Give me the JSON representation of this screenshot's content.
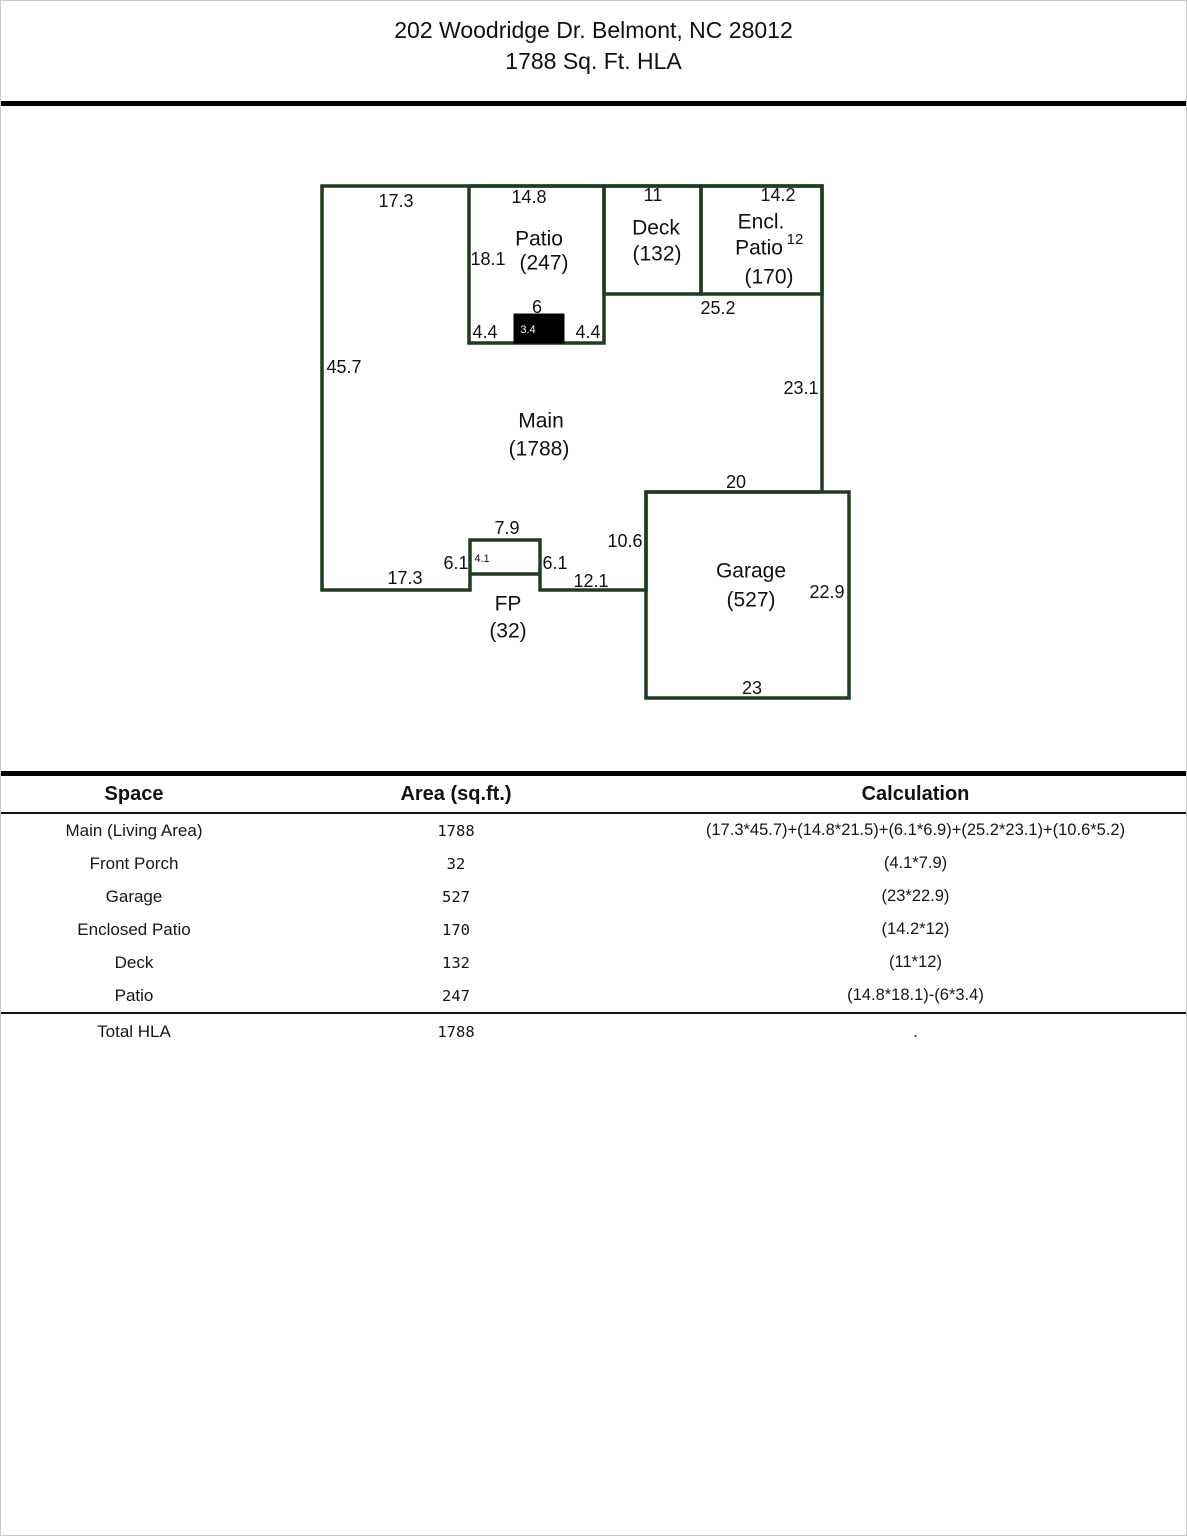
{
  "header": {
    "line1": "202 Woodridge Dr. Belmont, NC 28012",
    "line2": "1788 Sq. Ft. HLA"
  },
  "colors": {
    "plan_line": "#1e3c20",
    "divider": "#000000",
    "text": "#111111"
  },
  "plan": {
    "rooms": {
      "patio_name": "Patio",
      "patio_area": "(247)",
      "deck_name": "Deck",
      "deck_area": "(132)",
      "encl_name_line1": "Encl.",
      "encl_name_line2": "Patio",
      "encl_area": "(170)",
      "main_name": "Main",
      "main_area": "(1788)",
      "fp_name": "FP",
      "fp_area": "(32)",
      "garage_name": "Garage",
      "garage_area": "(527)"
    },
    "dims": {
      "top_left_width": "17.3",
      "patio_width": "14.8",
      "deck_width": "11",
      "encl_width": "14.2",
      "encl_depth": "12",
      "patio_depth": "18.1",
      "chimney_width": "6",
      "chimney_depth": "3.4",
      "patio_bottom_left": "4.4",
      "patio_bottom_right": "4.4",
      "below_deck_width": "25.2",
      "left_height": "45.7",
      "right_height": "23.1",
      "garage_top_width": "20",
      "fp_width": "7.9",
      "garage_left_height": "10.6",
      "fp_left_height": "6.1",
      "fp_depth": "4.1",
      "fp_right_height": "6.1",
      "bottom_mid_width": "12.1",
      "bottom_left_width": "17.3",
      "garage_right_height": "22.9",
      "garage_bottom_width": "23"
    }
  },
  "table": {
    "columns": {
      "space": "Space",
      "area": "Area (sq.ft.)",
      "calc": "Calculation"
    },
    "rows": [
      {
        "space": "Main (Living Area)",
        "area": "1788",
        "calc": "(17.3*45.7)+(14.8*21.5)+(6.1*6.9)+(25.2*23.1)+(10.6*5.2)"
      },
      {
        "space": "Front Porch",
        "area": "32",
        "calc": "(4.1*7.9)"
      },
      {
        "space": "Garage",
        "area": "527",
        "calc": "(23*22.9)"
      },
      {
        "space": "Enclosed Patio",
        "area": "170",
        "calc": "(14.2*12)"
      },
      {
        "space": "Deck",
        "area": "132",
        "calc": "(11*12)"
      },
      {
        "space": "Patio",
        "area": "247",
        "calc": "(14.8*18.1)-(6*3.4)"
      }
    ],
    "total": {
      "space": "Total HLA",
      "area": "1788",
      "calc": "."
    }
  }
}
